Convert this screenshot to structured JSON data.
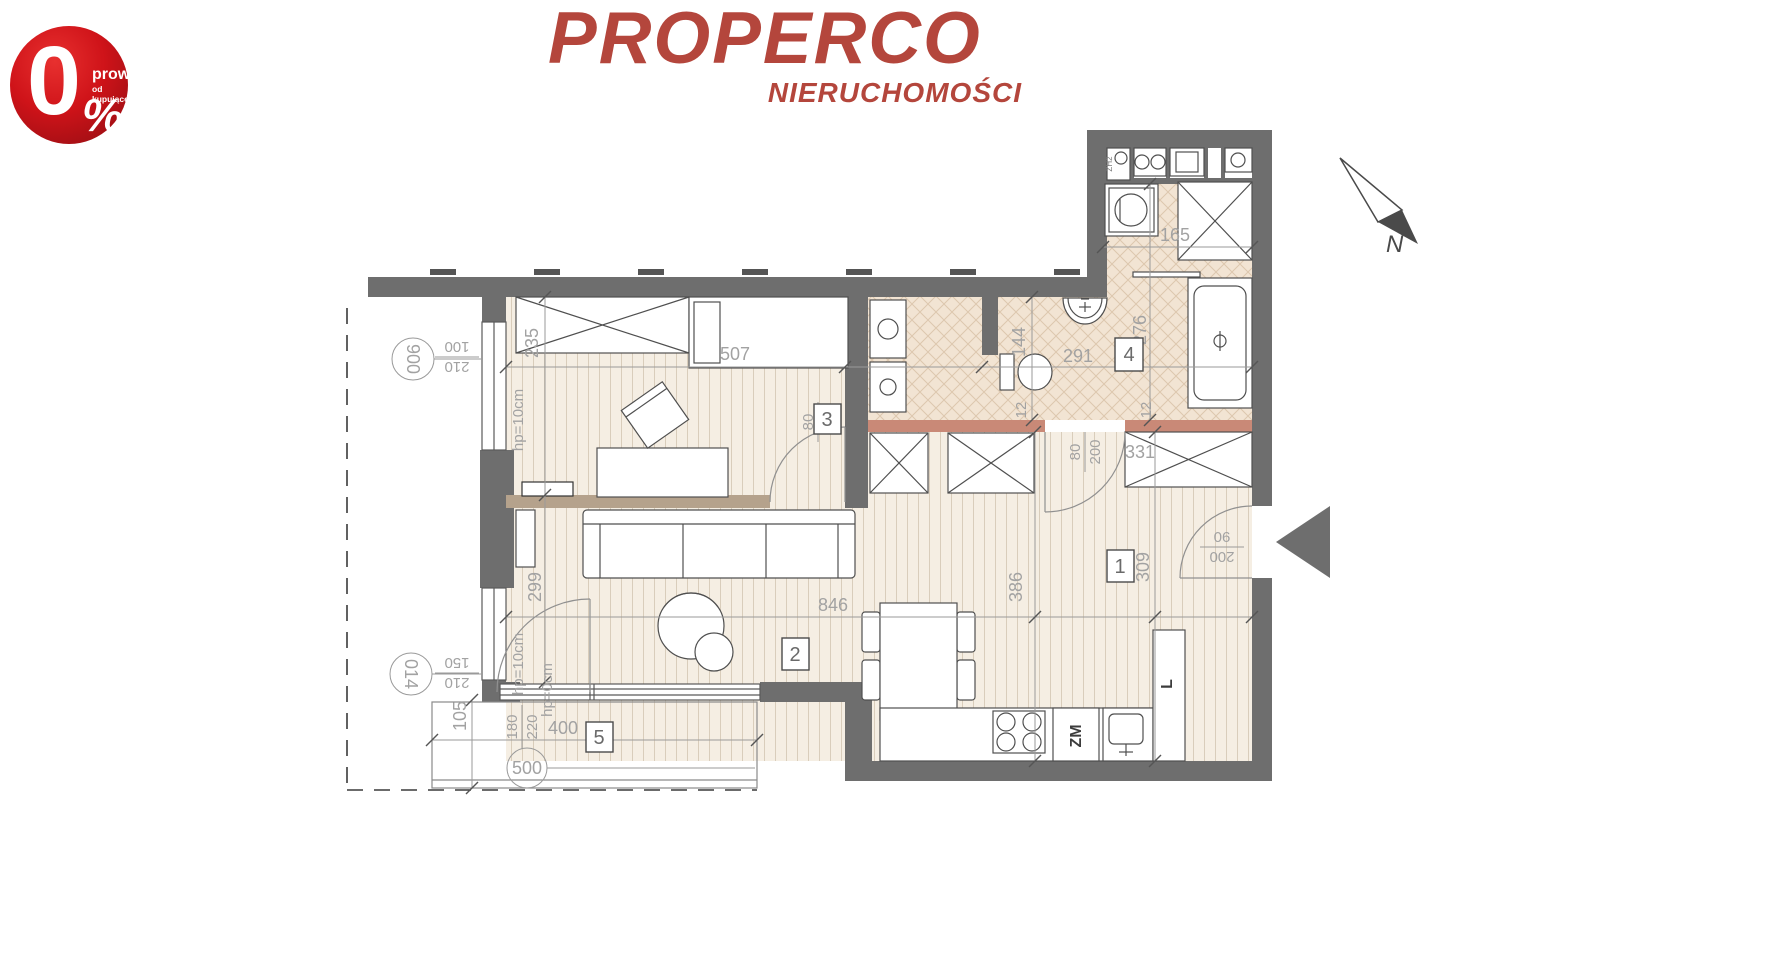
{
  "badge": {
    "percent_zero": "0",
    "percent_sign": "%",
    "line1": "prowizji",
    "line2": "od kupującego"
  },
  "logo": {
    "brand": "PROPERCO",
    "subtitle": "NIERUCHOMOŚCI"
  },
  "north": {
    "label": "N"
  },
  "rooms": {
    "r1": "1",
    "r2": "2",
    "r3": "3",
    "r4": "4",
    "r5": "5"
  },
  "dims": {
    "w507": "507",
    "w291": "291",
    "w165": "165",
    "w846": "846",
    "w331": "331",
    "w400": "400",
    "h235": "235",
    "h144": "144",
    "h276": "276",
    "h299": "299",
    "h386": "386",
    "h309": "309",
    "h105": "105",
    "t12a": "12",
    "t12b": "12"
  },
  "doors": {
    "d3_w": "80",
    "d3_h": "200",
    "bath_w": "80",
    "bath_h": "200",
    "entry_h": "200",
    "entry_w": "90"
  },
  "windows": {
    "win1_ref": "900",
    "win1_a": "210",
    "win1_b": "100",
    "win2_ref": "014",
    "win2_a": "210",
    "win2_b": "150",
    "balc_ref": "500",
    "balc_a": "180",
    "balc_b": "220",
    "hp1": "hp=10cm",
    "hp2": "hp=10cm",
    "hp3": "hp=0cm"
  },
  "appliances": {
    "dishwasher": "ZM",
    "fridge": "L",
    "unit": "ZH2"
  }
}
